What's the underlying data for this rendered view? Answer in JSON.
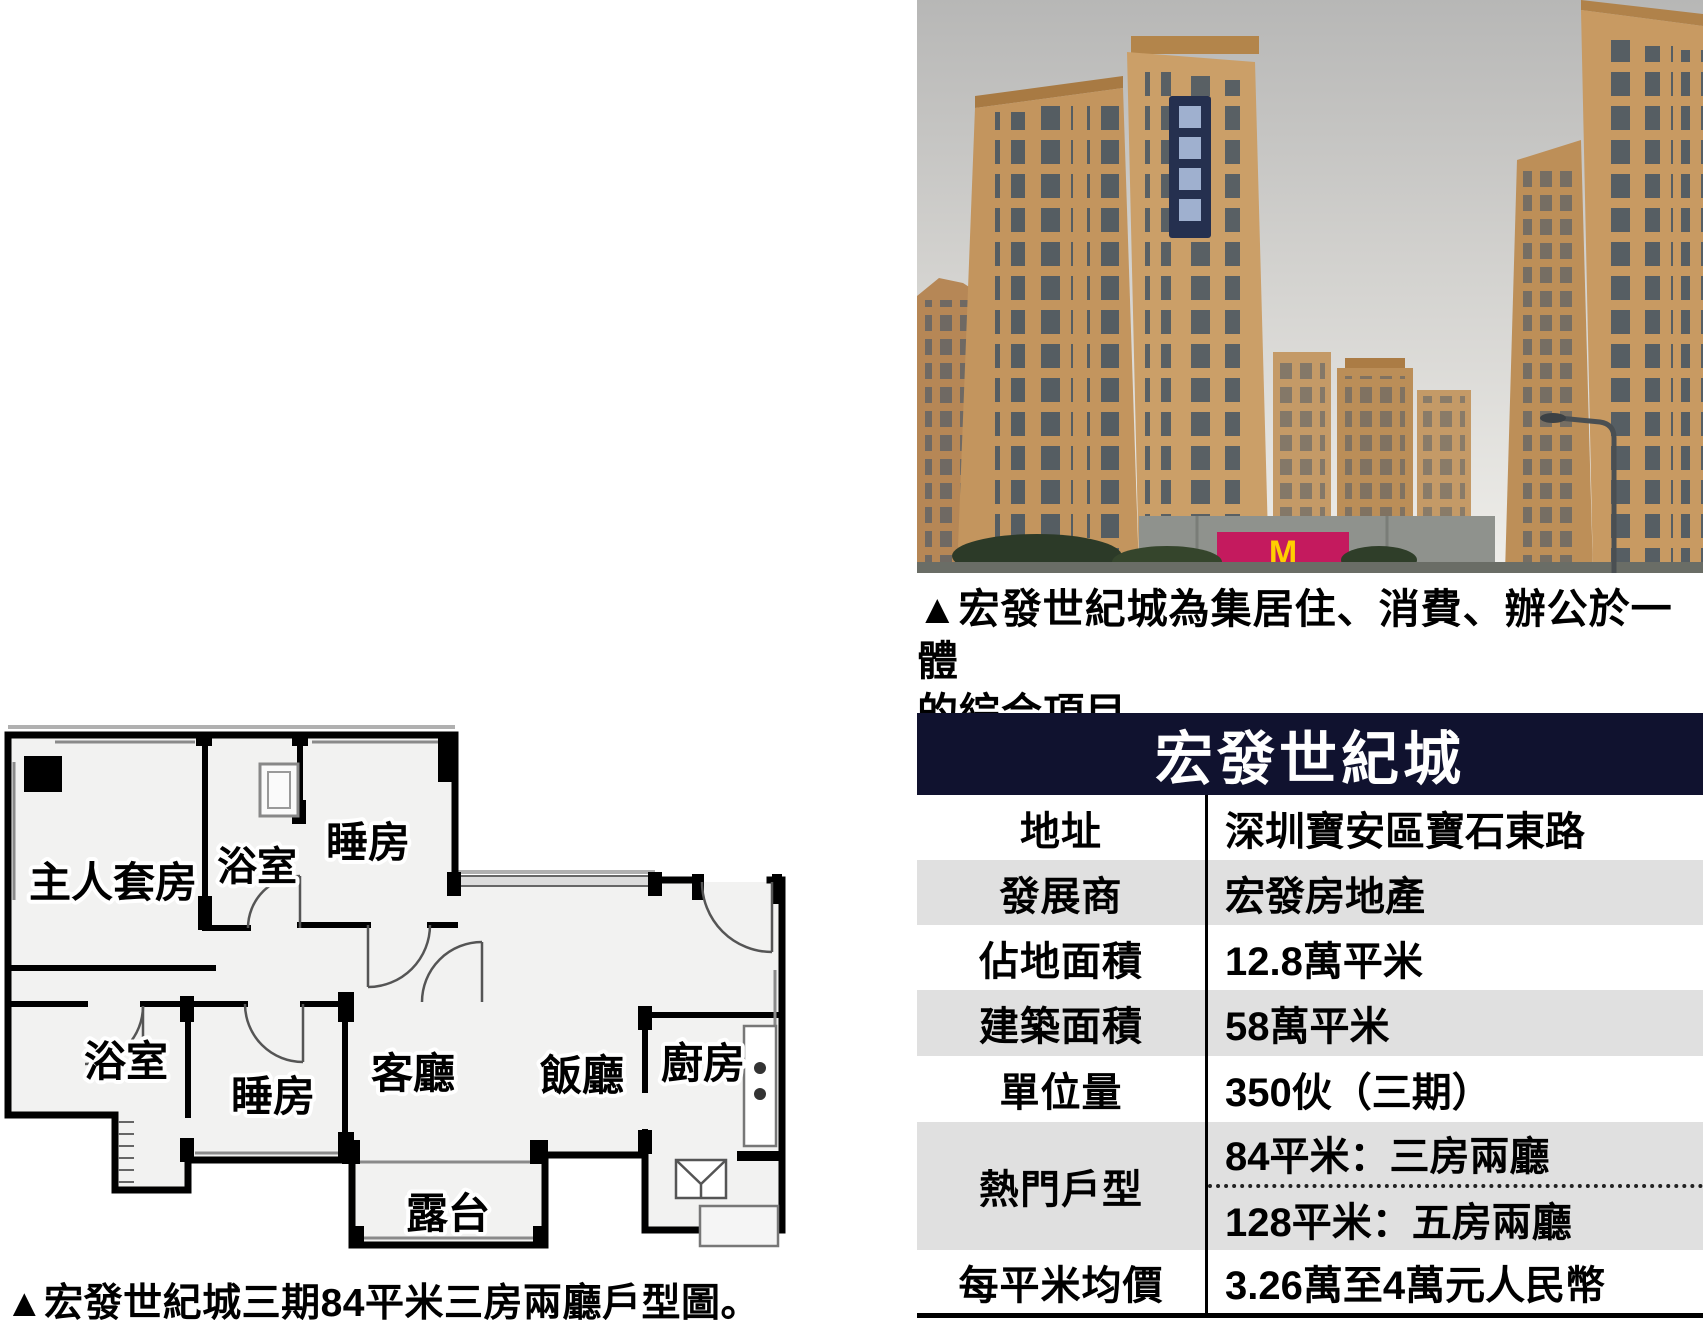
{
  "photo": {
    "caption_line1": "▲宏發世紀城為集居住、消費、辦公於一體",
    "caption_line2": "的綜合項目。",
    "podium_sign_letter": "M"
  },
  "floor_plan": {
    "caption": "▲宏發世紀城三期84平米三房兩廳戶型圖。",
    "rooms": {
      "master": "主人套房",
      "bath_top": "浴室",
      "bed_top": "睡房",
      "bath_bottom": "浴室",
      "bed_bottom": "睡房",
      "living": "客廳",
      "dining": "飯廳",
      "kitchen": "廚房",
      "balcony": "露台"
    }
  },
  "table": {
    "title": "宏發世紀城",
    "rows": [
      {
        "label": "地址",
        "value": "深圳寶安區寶石東路"
      },
      {
        "label": "發展商",
        "value": "宏發房地產"
      },
      {
        "label": "佔地面積",
        "value": "12.8萬平米"
      },
      {
        "label": "建築面積",
        "value": "58萬平米"
      },
      {
        "label": "單位量",
        "value": "350伙（三期）"
      },
      {
        "label": "熱門戶型",
        "value1": "84平米：三房兩廳",
        "value2": "128平米：五房兩廳"
      },
      {
        "label": "每平米均價",
        "value": "3.26萬至4萬元人民幣"
      }
    ]
  },
  "colors": {
    "table_header_bg": "#10122f",
    "table_alt_row_bg": "#e0e0e0",
    "table_rule": "#000000",
    "tower_tan": "#c3955e",
    "podium_sign_magenta": "#c41a5e",
    "podium_sign_yellow": "#ffcf00",
    "sky_gray": "#cfcecb"
  }
}
